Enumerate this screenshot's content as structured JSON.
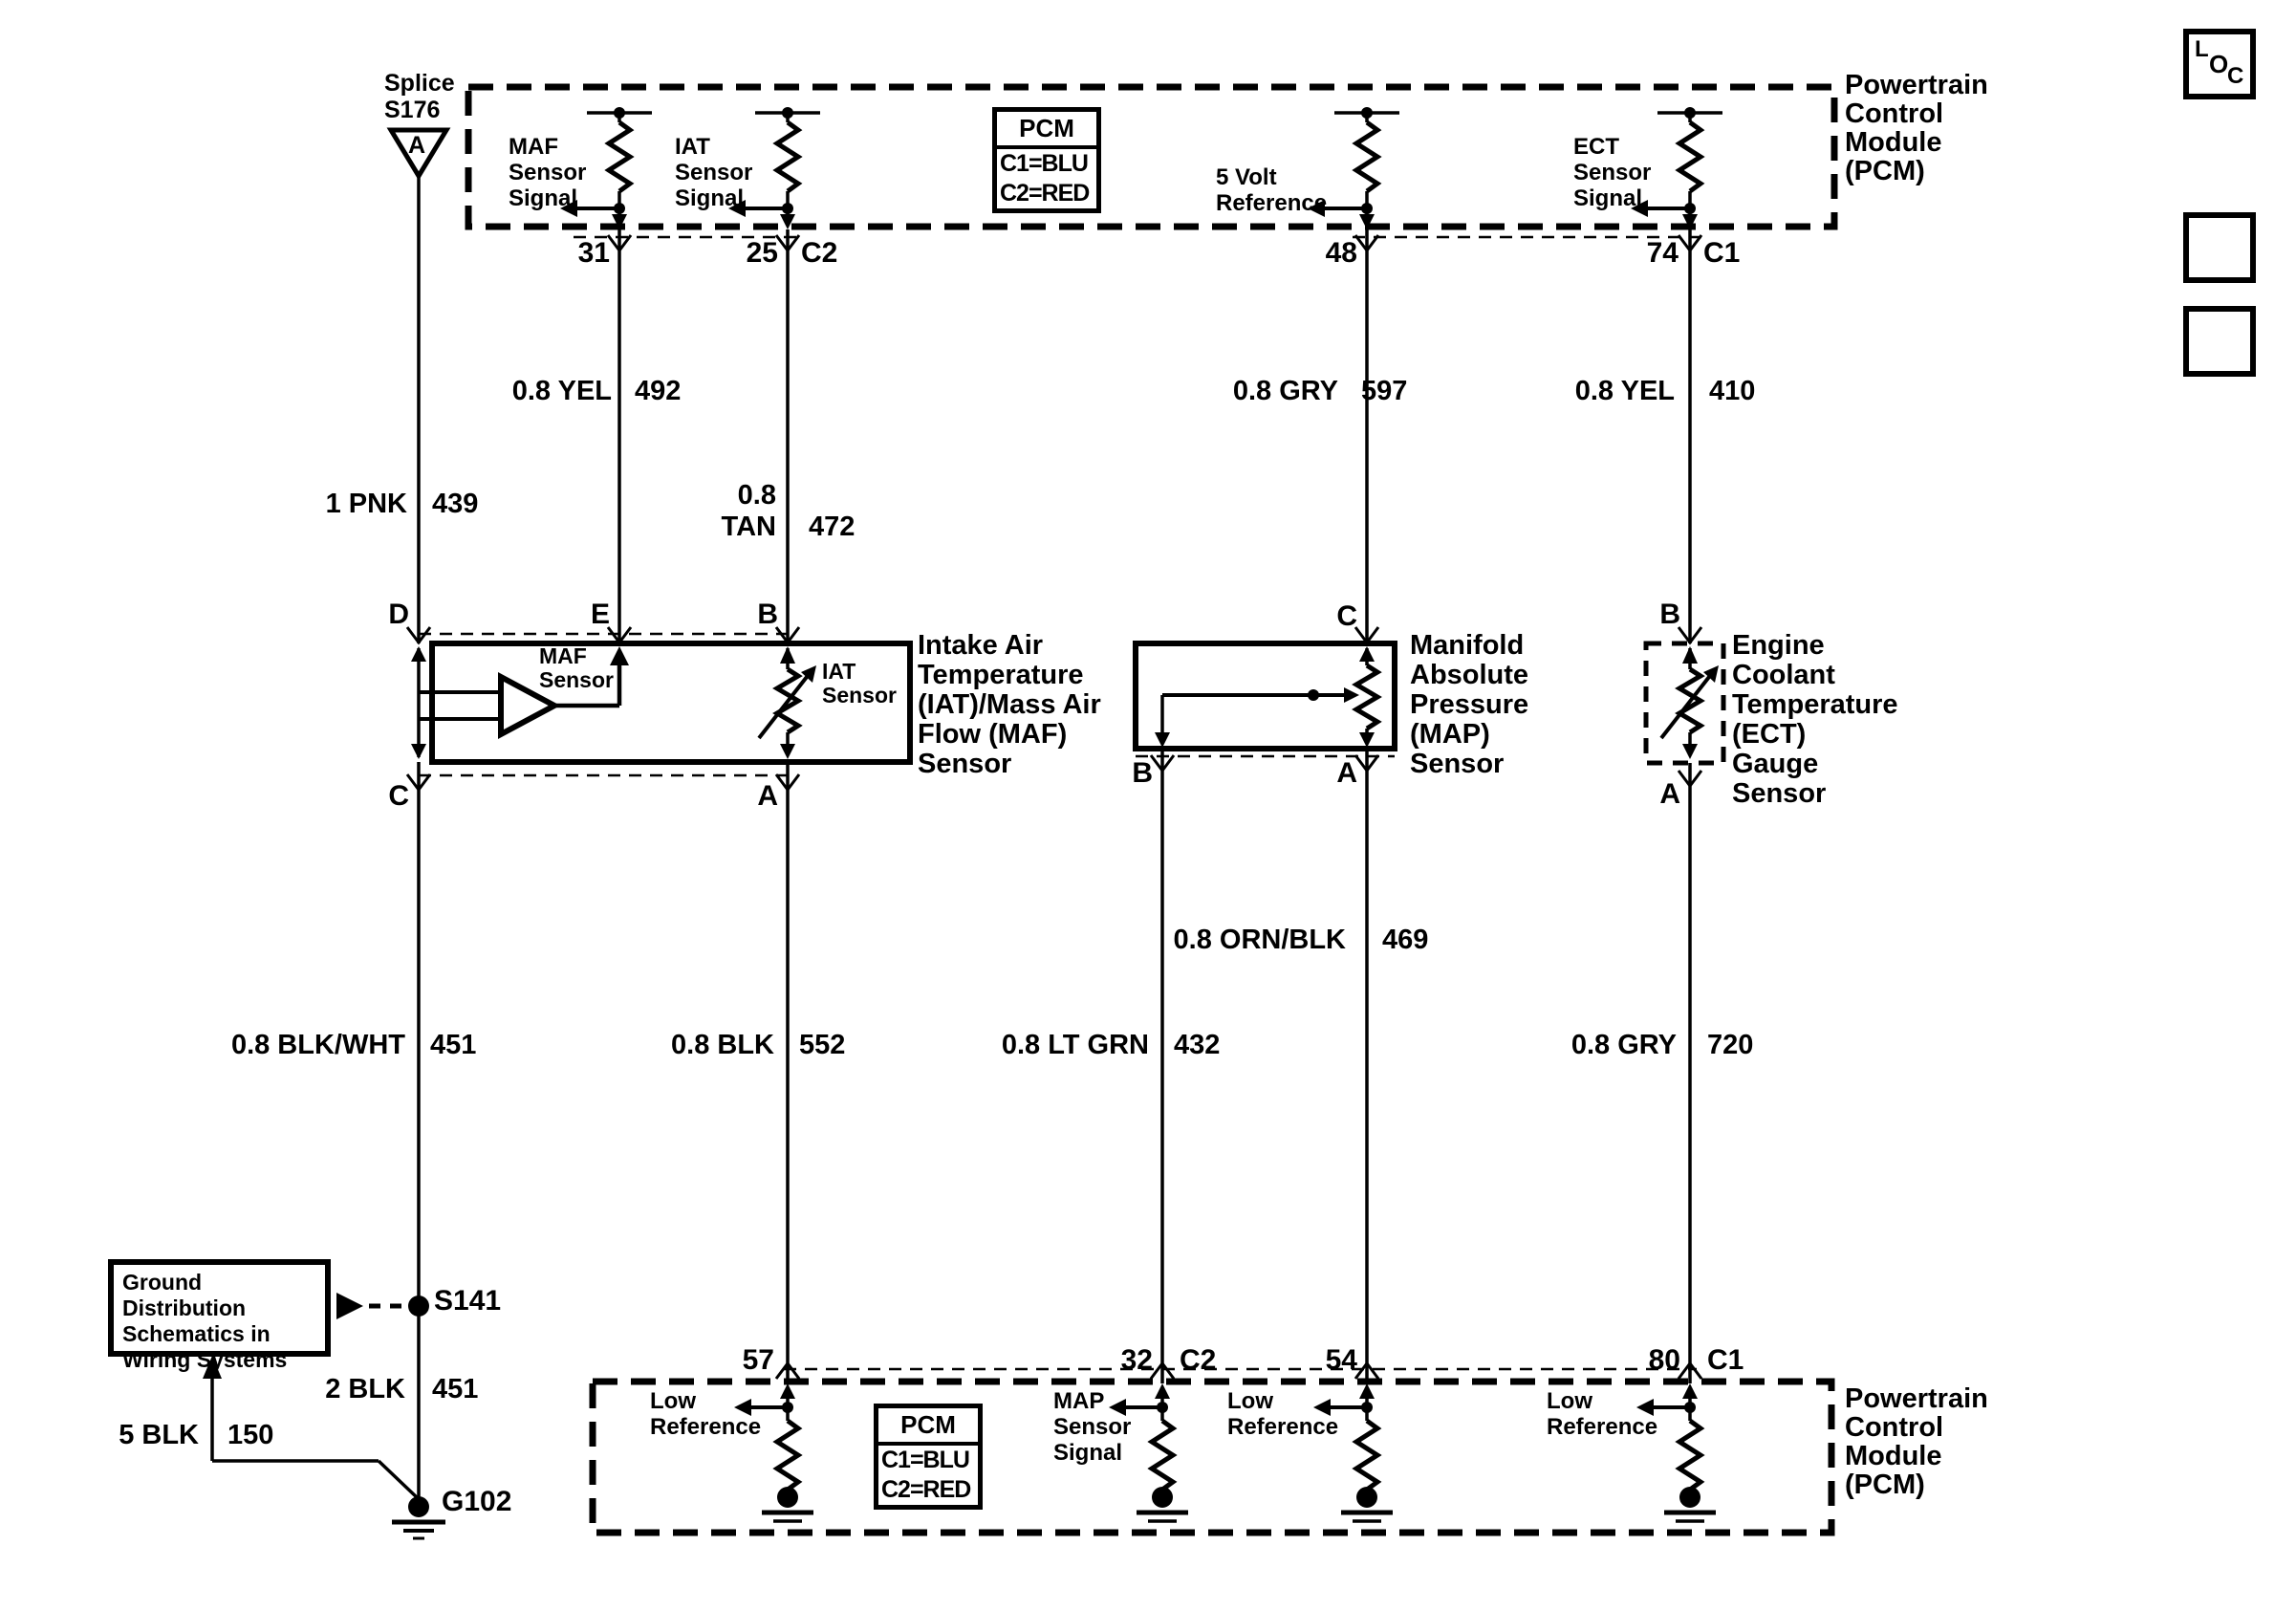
{
  "top_pcm": {
    "title": "Powertrain\nControl\nModule\n(PCM)",
    "legend": {
      "title": "PCM",
      "rows": [
        "C1=BLU",
        "C2=RED"
      ]
    },
    "maf_signal": "MAF\nSensor\nSignal",
    "iat_signal": "IAT\nSensor\nSignal",
    "five_volt": "5 Volt\nReference",
    "ect_signal": "ECT\nSensor\nSignal",
    "pins": {
      "maf": "31",
      "iat": "25",
      "iat_conn": "C2",
      "five_volt": "48",
      "ect": "74",
      "ect_conn": "C1"
    }
  },
  "splice": {
    "title": "Splice\nS176",
    "terminal": "A"
  },
  "wires": {
    "pnk_439": {
      "gauge_color": "1 PNK",
      "circuit": "439"
    },
    "yel_492": {
      "gauge_color": "0.8 YEL",
      "circuit": "492"
    },
    "tan_472": {
      "gauge_color": "0.8\nTAN",
      "circuit": "472"
    },
    "gry_597": {
      "gauge_color": "0.8 GRY",
      "circuit": "597"
    },
    "yel_410": {
      "gauge_color": "0.8 YEL",
      "circuit": "410"
    },
    "orn_blk_469": {
      "gauge_color": "0.8 ORN/BLK",
      "circuit": "469"
    },
    "blk_wht_451": {
      "gauge_color": "0.8 BLK/WHT",
      "circuit": "451"
    },
    "blk_552": {
      "gauge_color": "0.8 BLK",
      "circuit": "552"
    },
    "lt_grn_432": {
      "gauge_color": "0.8 LT GRN",
      "circuit": "432"
    },
    "gry_720": {
      "gauge_color": "0.8 GRY",
      "circuit": "720"
    },
    "blk_451": {
      "gauge_color": "2 BLK",
      "circuit": "451"
    },
    "blk_150": {
      "gauge_color": "5 BLK",
      "circuit": "150"
    }
  },
  "maf_iat_sensor": {
    "title": "Intake Air\nTemperature\n(IAT)/Mass Air\nFlow (MAF)\nSensor",
    "maf_label": "MAF\nSensor",
    "iat_label": "IAT\nSensor",
    "terminals": {
      "d": "D",
      "e": "E",
      "b": "B",
      "c": "C",
      "a": "A"
    }
  },
  "map_sensor": {
    "title": "Manifold\nAbsolute\nPressure\n(MAP)\nSensor",
    "terminals": {
      "c": "C",
      "b": "B",
      "a": "A"
    }
  },
  "ect_sensor": {
    "title": "Engine\nCoolant\nTemperature\n(ECT)\nGauge\nSensor",
    "terminals": {
      "b": "B",
      "a": "A"
    }
  },
  "ground": {
    "note": "Ground Distribution\nSchematics in\nWiring Systems",
    "splice": "S141",
    "ground_id": "G102"
  },
  "bottom_pcm": {
    "title": "Powertrain\nControl\nModule\n(PCM)",
    "legend": {
      "title": "PCM",
      "rows": [
        "C1=BLU",
        "C2=RED"
      ]
    },
    "low_ref_iat": "Low\nReference",
    "map_signal": "MAP\nSensor\nSignal",
    "low_ref_map": "Low\nReference",
    "low_ref_ect": "Low\nReference",
    "pins": {
      "iat": "57",
      "map_sig": "32",
      "map_sig_conn": "C2",
      "map_low": "54",
      "ect": "80",
      "ect_conn": "C1"
    }
  },
  "nav": {
    "loc": {
      "l": "L",
      "o": "O",
      "c": "C"
    }
  }
}
